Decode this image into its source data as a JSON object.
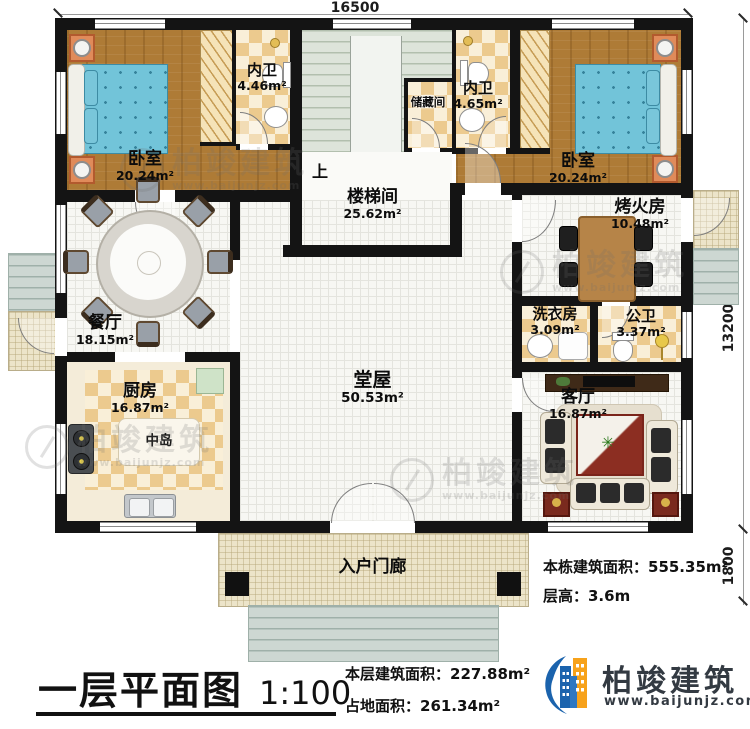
{
  "dims": {
    "top": "16500",
    "right": "13200",
    "right_porch": "1800"
  },
  "rooms": [
    {
      "id": "bedroom-left",
      "name": "卧室",
      "area": "20.24m²"
    },
    {
      "id": "bath-left",
      "name": "内卫",
      "area": "4.46m²"
    },
    {
      "id": "storage",
      "name": "储藏间",
      "area": ""
    },
    {
      "id": "bath-right",
      "name": "内卫",
      "area": "4.65m²"
    },
    {
      "id": "bedroom-right",
      "name": "卧室",
      "area": "20.24m²"
    },
    {
      "id": "stairwell",
      "name": "楼梯间",
      "area": "25.62m²",
      "up": "上"
    },
    {
      "id": "fire-room",
      "name": "烤火房",
      "area": "10.48m²"
    },
    {
      "id": "dining",
      "name": "餐厅",
      "area": "18.15m²"
    },
    {
      "id": "laundry",
      "name": "洗衣房",
      "area": "3.09m²"
    },
    {
      "id": "public-bath",
      "name": "公卫",
      "area": "3.37m²"
    },
    {
      "id": "kitchen",
      "name": "厨房",
      "area": "16.87m²",
      "island": "中岛"
    },
    {
      "id": "hall",
      "name": "堂屋",
      "area": "50.53m²"
    },
    {
      "id": "living",
      "name": "客厅",
      "area": "16.87m²"
    },
    {
      "id": "porch",
      "name": "入户门廊",
      "area": ""
    }
  ],
  "info": {
    "total_area": "本栋建筑面积：555.35m²",
    "floor_height": "层高：3.6m"
  },
  "footer": {
    "plan_title": "一层平面图",
    "scale": "1:100",
    "floor_area": "本层建筑面积：227.88m²",
    "site_area": "占地面积：261.34m²"
  },
  "logo": {
    "name": "柏竣建筑",
    "url": "www.baijunjz.com"
  },
  "watermark": {
    "text": "柏竣建筑",
    "url": "www.baijunjz.com"
  },
  "colors": {
    "wall": "#141414",
    "wood": "#ae7b36",
    "tile": "#ecca8e",
    "logo_blue": "#1b63ad",
    "logo_orange": "#f7a21b",
    "brand_text": "#333a42"
  }
}
